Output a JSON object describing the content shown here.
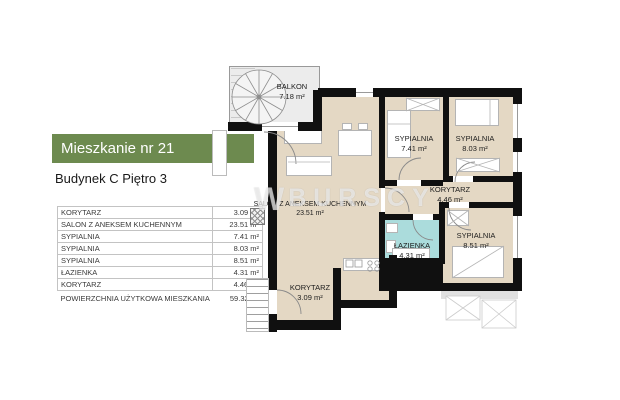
{
  "header": {
    "title": "Mieszkanie nr 21",
    "subtitle": "Budynek C Piętro 3"
  },
  "area_table": {
    "rows": [
      {
        "name": "KORYTARZ",
        "area": "3.09 m²"
      },
      {
        "name": "SALON Z ANEKSEM KUCHENNYM",
        "area": "23.51 m²"
      },
      {
        "name": "SYPIALNIA",
        "area": "7.41 m²"
      },
      {
        "name": "SYPIALNIA",
        "area": "8.03 m²"
      },
      {
        "name": "SYPIALNIA",
        "area": "8.51 m²"
      },
      {
        "name": "ŁAZIENKA",
        "area": "4.31 m²"
      },
      {
        "name": "KORYTARZ",
        "area": "4.46 m²"
      }
    ],
    "total_name": "POWIERZCHNIA UŻYTKOWA MIESZKANIA",
    "total_area": "59.32 m²"
  },
  "floor_plan": {
    "watermark_prefix": "W",
    "watermark_text": "BURSCY",
    "rooms": {
      "balkon": {
        "label": "BALKON",
        "area": "7.18 m²"
      },
      "salon": {
        "label": "SALON Z ANEKSEM KUCHENNYM",
        "area": "23.51 m²"
      },
      "sypialnia_741": {
        "label": "SYPIALNIA",
        "area": "7.41 m²"
      },
      "sypialnia_803": {
        "label": "SYPIALNIA",
        "area": "8.03 m²"
      },
      "korytarz_446": {
        "label": "KORYTARZ",
        "area": "4.46 m²"
      },
      "lazienka": {
        "label": "ŁAZIENKA",
        "area": "4.31 m²"
      },
      "sypialnia_851": {
        "label": "SYPIALNIA",
        "area": "8.51 m²"
      },
      "korytarz_309": {
        "label": "KORYTARZ",
        "area": "3.09 m²"
      }
    },
    "colors": {
      "accent_green": "#6d8a4f",
      "room_fill": "#e4d8c4",
      "bathroom_fill": "#abdcdc",
      "balcony_fill": "#ececec",
      "wall": "#101010"
    }
  }
}
